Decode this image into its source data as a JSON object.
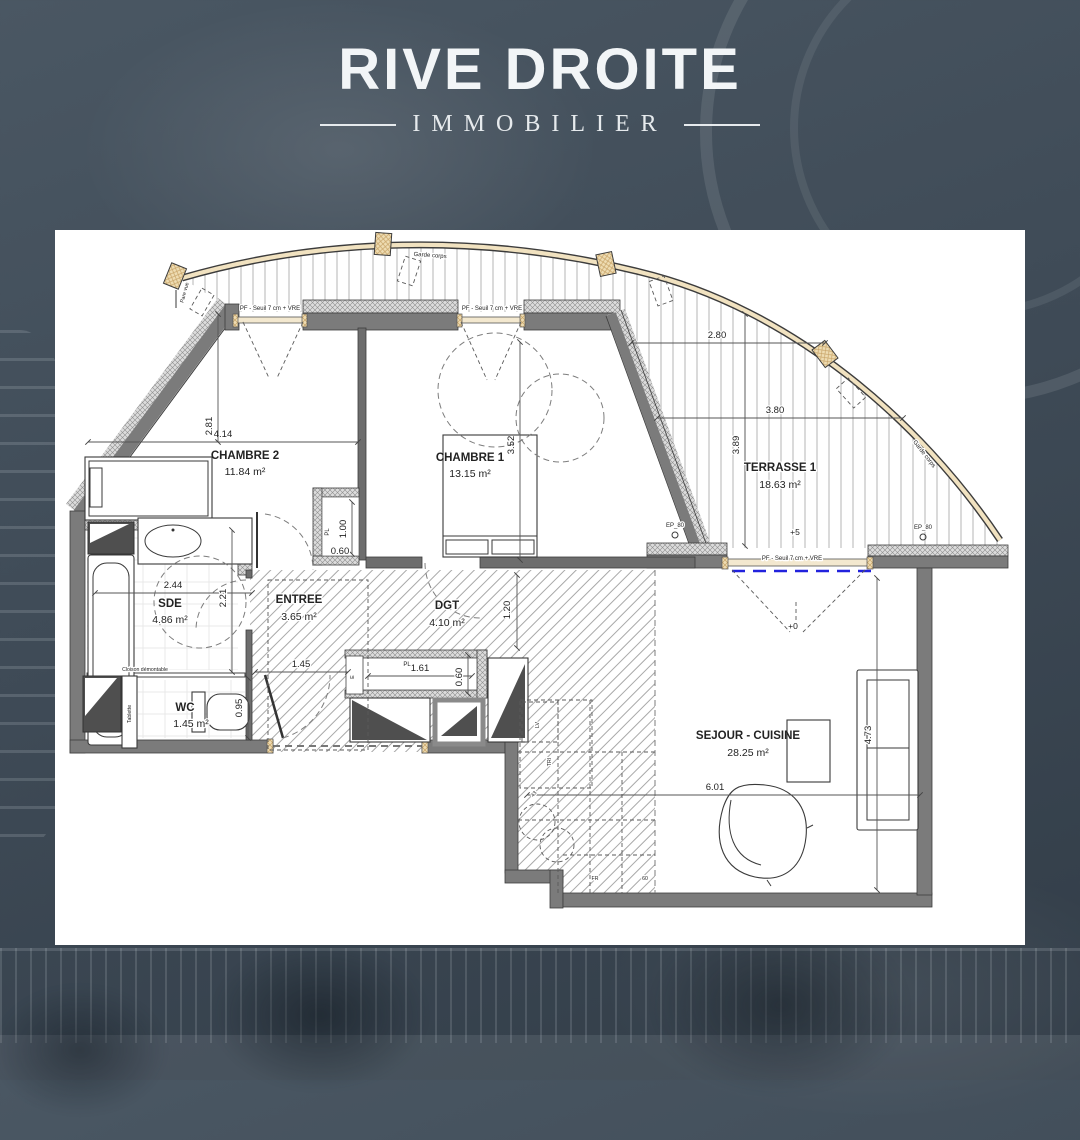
{
  "brand": {
    "name": "RIVE DROITE",
    "tagline": "IMMOBILIER"
  },
  "colors": {
    "background": "#3f4b57",
    "panel": "#ffffff",
    "wall_gray": "#7b7b7b",
    "wood": "#eedcb2",
    "accent_blue": "#2222dd",
    "brand_text": "#f2f5f7"
  },
  "rooms": [
    {
      "name": "CHAMBRE 2",
      "area": "11.84 m²"
    },
    {
      "name": "CHAMBRE 1",
      "area": "13.15 m²"
    },
    {
      "name": "TERRASSE 1",
      "area": "18.63 m²"
    },
    {
      "name": "SDE",
      "area": "4.86 m²"
    },
    {
      "name": "WC",
      "area": "1.45 m²"
    },
    {
      "name": "ENTREE",
      "area": "3.65 m²"
    },
    {
      "name": "DGT",
      "area": "4.10 m²"
    },
    {
      "name": "SEJOUR - CUISINE",
      "area": "28.25 m²"
    }
  ],
  "dims": {
    "ch2_w": "4.14",
    "ch2_h": "2.81",
    "ch1_h": "3.52",
    "ter_w1": "2.80",
    "ter_w2": "3.80",
    "ter_h": "3.89",
    "sde_w": "2.44",
    "sde_h": "2.21",
    "wc_h": "0.95",
    "entree_w": "1.45",
    "dgt_h": "1.20",
    "pl1_h": "1.00",
    "pl1_w": "0.60",
    "pl2_w": "1.61",
    "pl2_d": "0.60",
    "sej_w": "6.01",
    "sej_h": "4.73"
  },
  "annotations": {
    "window_label": "PF - Seuil 7 cm + VRE",
    "guardrail": "Garde corps",
    "privacy_screen": "Pare vue",
    "drain": "EP_80",
    "level_terrace": "+5",
    "level_interior": "+0",
    "partition": "Cloison démontable",
    "shelf": "Tablette",
    "closet": "PL",
    "dishwasher": "LV",
    "fridge": "FR",
    "trash": "TRI",
    "k60": "60",
    "k43": "43",
    "elec": "E"
  }
}
